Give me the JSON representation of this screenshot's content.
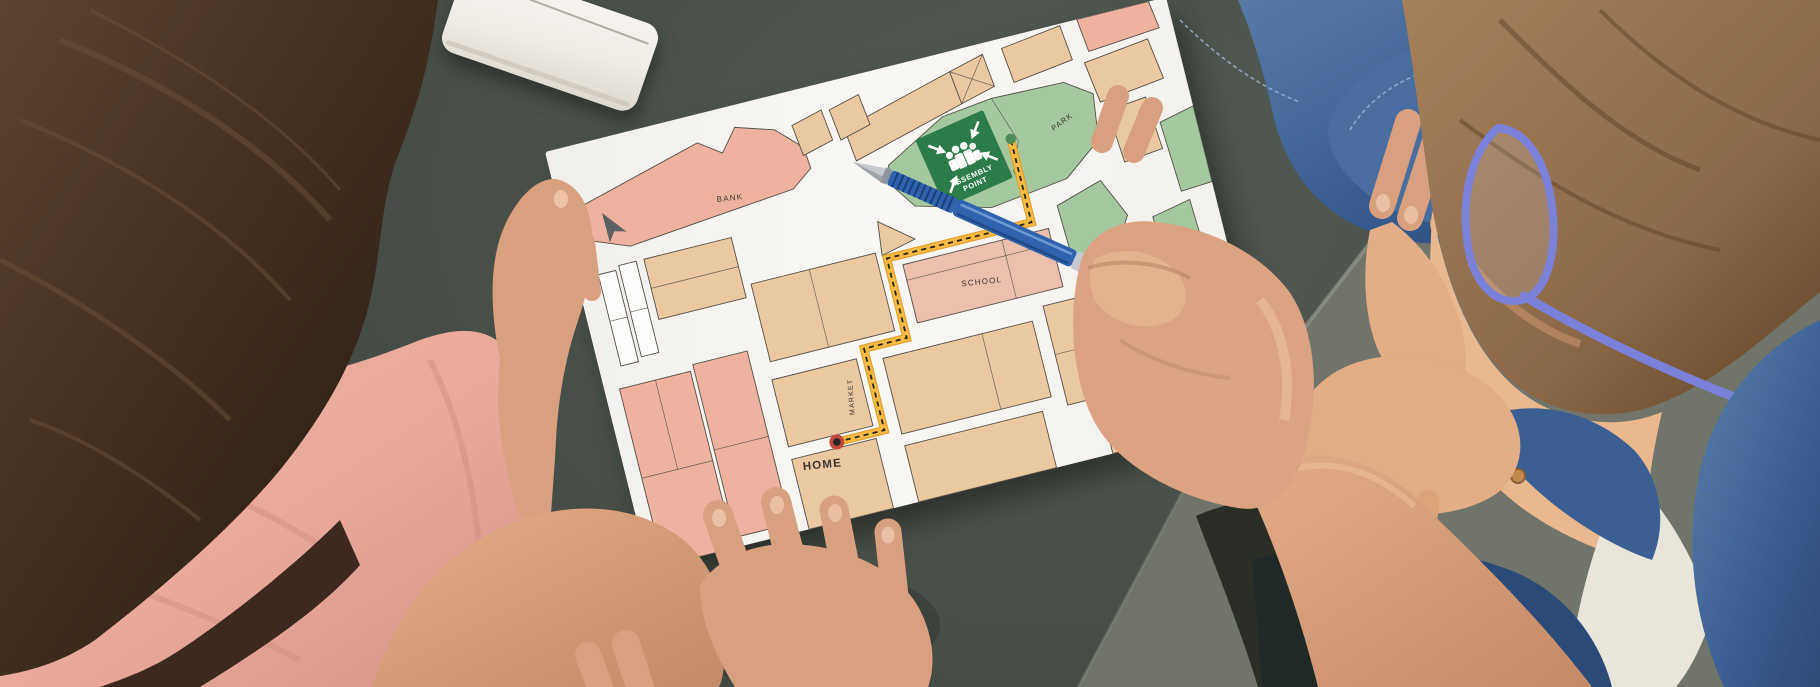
{
  "map": {
    "labels": {
      "bank": "BANK",
      "school": "SCHOOL",
      "park": "PARK",
      "market": "MARKET",
      "home": "HOME",
      "assembly_line1": "ASSEMBLY",
      "assembly_line2": "POINT"
    },
    "icons": [
      "assembly-point-sign",
      "compass-arrow-icon",
      "home-marker-icon",
      "destination-dot-icon",
      "route-path",
      "crossed-square-icon"
    ]
  },
  "objects": {
    "phone": "white-smartphone",
    "pen": "blue-ballpoint-pen",
    "paper": "evacuation-street-map"
  },
  "css_vars": {
    "table": "#565d56",
    "floor": "#70746b",
    "tableedge": "#94978c",
    "paper": "#f8f7f4",
    "tan": "#ebc9a0",
    "salmon": "#efb2a0",
    "schoolpink": "#edbfae",
    "parkgreen": "#a5c8a0",
    "signgreen": "#2c7b4b",
    "routeyellow": "#f6ba42",
    "routeedge": "#dd9e2c",
    "routedash": "#2a241f",
    "markerring": "#c04a3e",
    "markercore": "#2a2522",
    "destdot": "#4f8a58",
    "outline": "#55504a",
    "whiteblock": "#fdfdfc",
    "labelink": "#3a3632",
    "compass": "#5d6164",
    "penblue": "#2f63ad",
    "pendark": "#1c3f78",
    "pensilver": "#c6cacf",
    "glasses": "#7b80d8",
    "denim": "#3b5f93",
    "denimdark": "#2c4a78",
    "denimlight": "#5b80ac",
    "denimcuff": "#4a6d9f",
    "stitch": "#9db8d4",
    "tee": "#e9e5da",
    "hairgirl": "#3f2d1f",
    "hairgirlstreak": "#6b503a",
    "shirt": "#e9a89b",
    "shirtshadow": "#cf8b80",
    "skin": "#d9a07f",
    "skinlight": "#eec6a8",
    "skindark": "#b67f61",
    "boyhair": "#8d6a49",
    "face": "#e9b88f",
    "shadow": "#20241d"
  }
}
